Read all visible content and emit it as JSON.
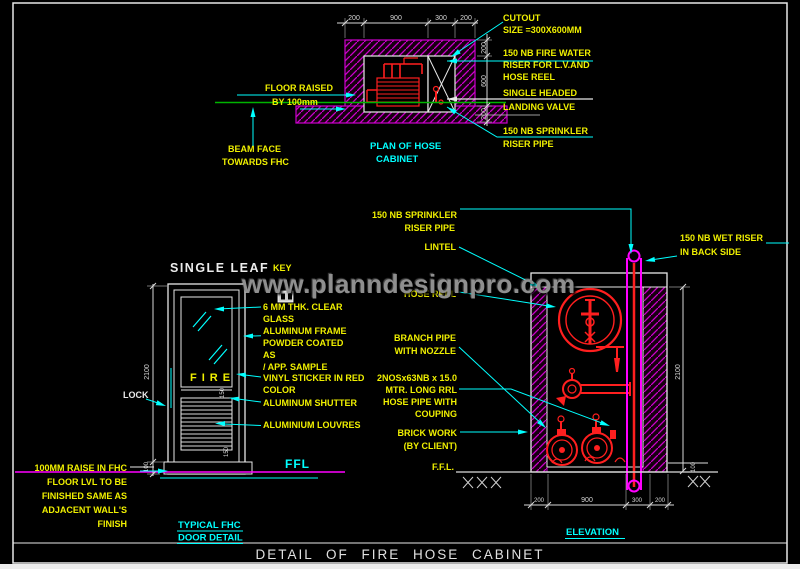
{
  "colors": {
    "background": "#000000",
    "wall_hatch_magenta": "#cc00cc",
    "ffl_magenta": "#ff00ff",
    "pipe_red": "#ff1f1f",
    "label_yellow": "#f0f000",
    "leader_cyan": "#00ffff",
    "beam_green": "#00b400",
    "line_white": "#e8e8e8"
  },
  "watermark": "www.planndesignpro.com",
  "plan": {
    "caption_line1": "PLAN OF  HOSE",
    "caption_line2": "CABINET",
    "floor_raised_line1": "FLOOR RAISED",
    "floor_raised_line2": "BY 100mm",
    "beam_face_line1": "BEAM FACE",
    "beam_face_line2": "TOWARDS FHC",
    "dims_top": [
      "200",
      "900",
      "300",
      "200"
    ],
    "dims_right": [
      "200",
      "600",
      "200"
    ],
    "callouts": {
      "cutout_line1": "CUTOUT",
      "cutout_line2": "SIZE =300X600MM",
      "fire_water_line1": "150 NB FIRE WATER",
      "fire_water_line2": "RISER FOR L.V.AND",
      "fire_water_line3": "HOSE REEL",
      "landing_valve_line1": "SINGLE HEADED",
      "landing_valve_line2": "LANDING VALVE",
      "sprinkler_line1": "150 NB SPRINKLER",
      "sprinkler_line2": "RISER PIPE"
    }
  },
  "door": {
    "title": "SINGLE LEAF",
    "key_label": "KEY",
    "fire_text": "FIRE",
    "lock_label": "LOCK",
    "ffl_label": "FFL",
    "height_dim": "2100",
    "raise_dim": "100",
    "panel_dims": [
      "150",
      "150"
    ],
    "labels": {
      "glass_line1": "6 MM THK. CLEAR",
      "glass_line2": "GLASS",
      "frame_line1": "ALUMINUM FRAME",
      "frame_line2": "POWDER COATED",
      "frame_line3": "AS",
      "frame_line4": "/ APP. SAMPLE",
      "vinyl_line1": "VINYL STICKER IN RED",
      "vinyl_line2": "COLOR",
      "shutter": "ALUMINUM SHUTTER",
      "louvres": "ALUMINIUM LOUVRES"
    },
    "note_lines": [
      "100MM RAISE IN FHC",
      "FLOOR LVL TO BE",
      "FINISHED SAME AS",
      "ADJACENT WALL'S",
      "FINISH"
    ],
    "caption_line1": "TYPICAL FHC",
    "caption_line2": "DOOR DETAIL"
  },
  "elevation": {
    "caption": "ELEVATION",
    "ffl_label": "F.F.L.",
    "height_dim": "2100",
    "raise_dim": "100",
    "dims_bottom": [
      "200",
      "900",
      "300",
      "200"
    ],
    "callouts": {
      "sprinkler_line1": "150 NB SPRINKLER",
      "sprinkler_line2": "RISER PIPE",
      "lintel": "LINTEL",
      "hose_reel": "HOSE REEL",
      "branch_line1": "BRANCH PIPE",
      "branch_line2": "WITH NOZZLE",
      "hose_pipe_line1": "2NOSx63NB x 15.0",
      "hose_pipe_line2": "MTR. LONG RRL",
      "hose_pipe_line3": "HOSE PIPE  WITH",
      "hose_pipe_line4": "COUPING",
      "brick_line1": "BRICK WORK",
      "brick_line2": "(BY CLIENT)",
      "wet_riser_line1": "150 NB WET RISER",
      "wet_riser_line2": "IN BACK SIDE"
    }
  },
  "footer": {
    "title": "DETAIL OF FIRE HOSE CABINET"
  }
}
